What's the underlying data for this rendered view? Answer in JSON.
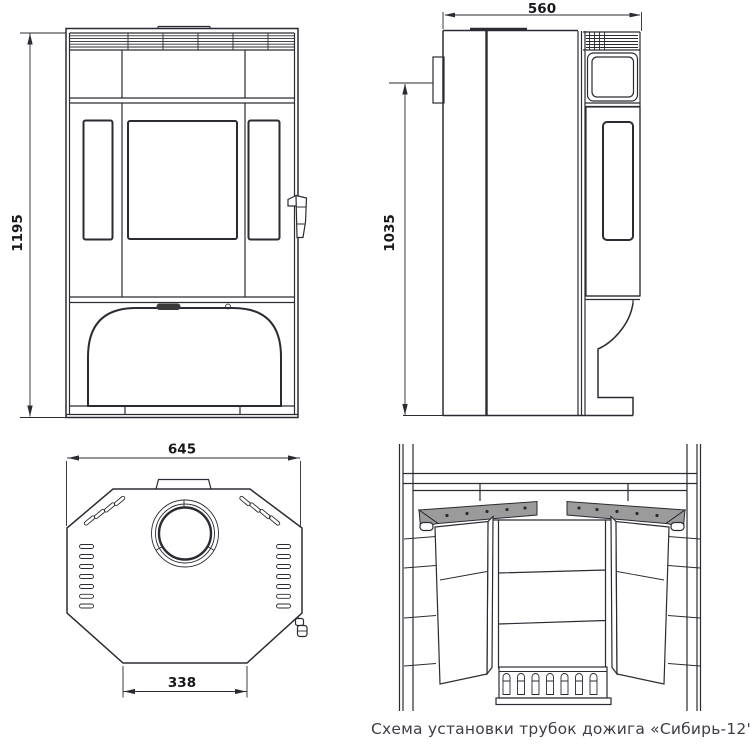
{
  "caption": "Схема установки трубок дожига «Сибирь-12'",
  "dimensions": {
    "front_height": "1195",
    "side_depth": "560",
    "side_height": "1035",
    "top_width": "645",
    "top_door_width": "338"
  },
  "colors": {
    "line": "#2b2b33",
    "plate": "#9b9b9b",
    "slot": "#3a3a3a",
    "dim_text": "#17171c",
    "caption": "#3d3d47"
  }
}
